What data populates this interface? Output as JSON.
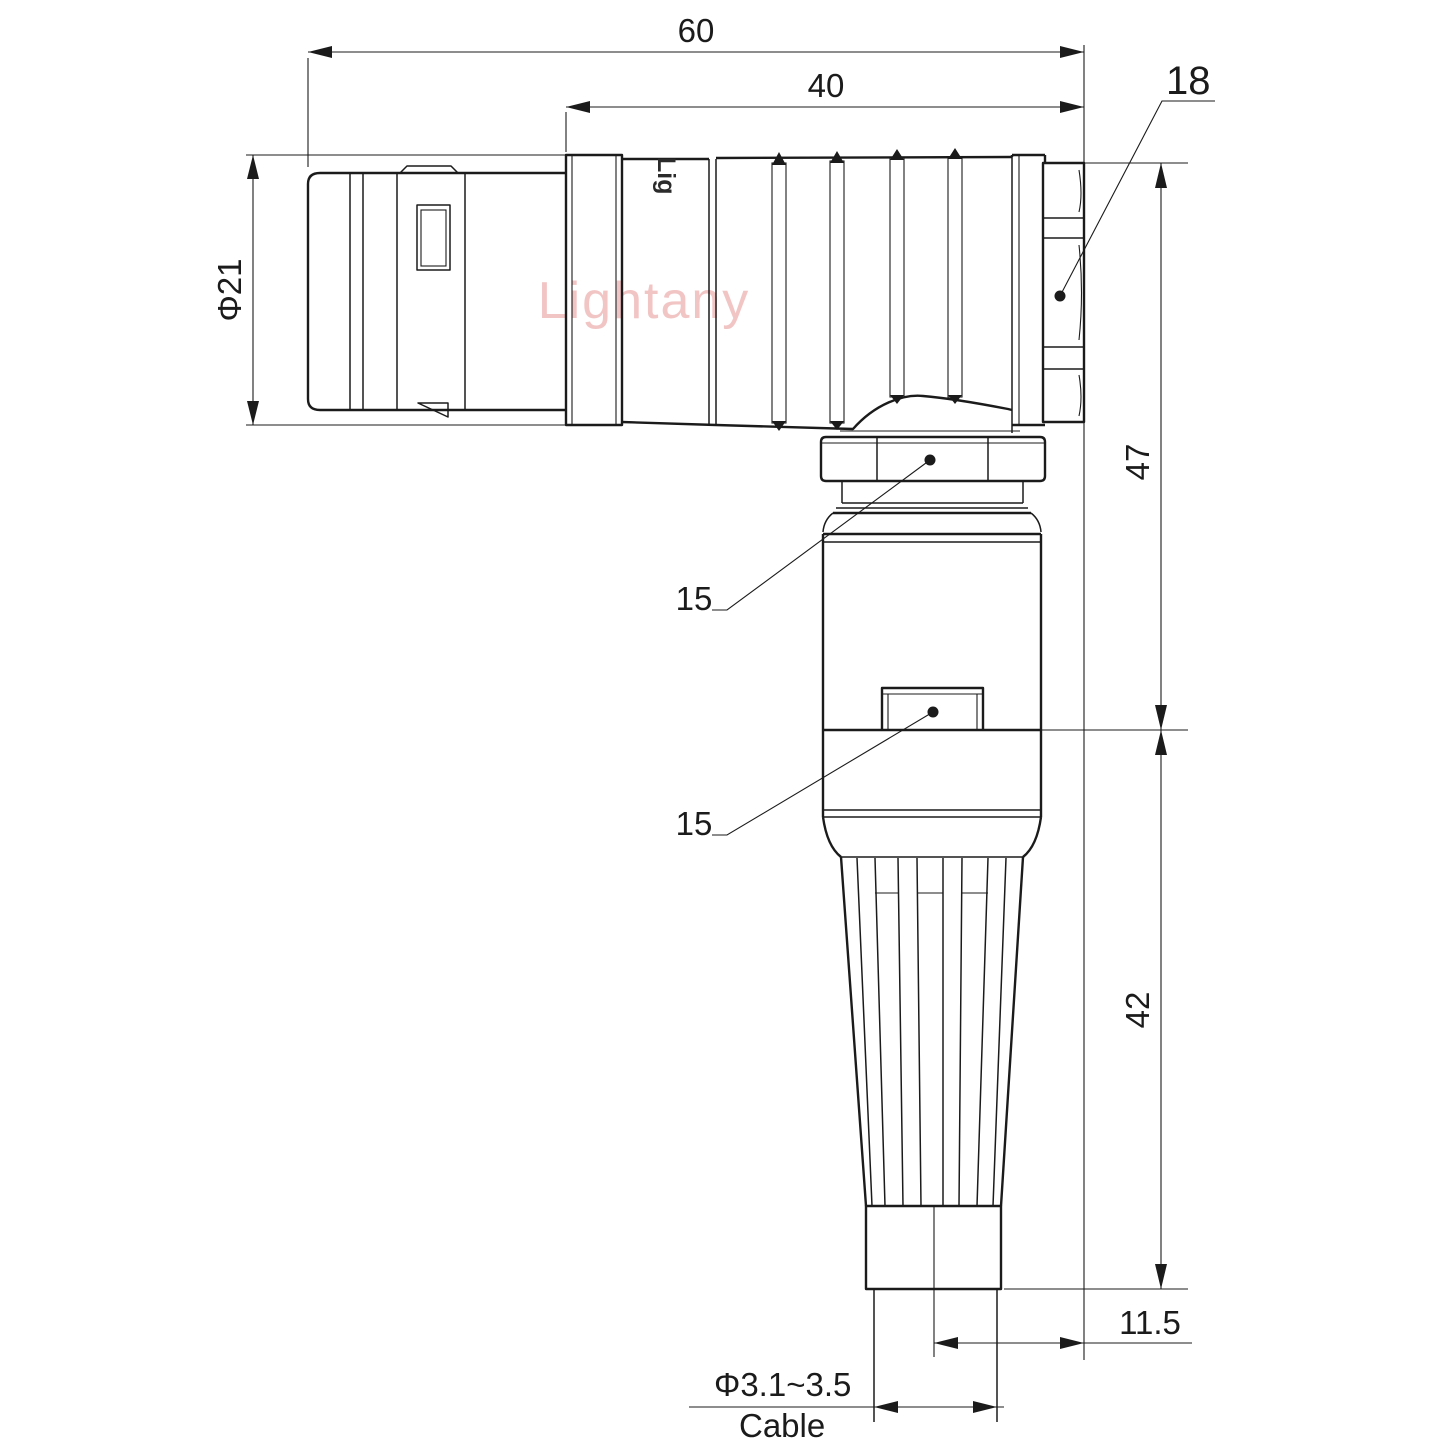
{
  "colors": {
    "line": "#1b1b1b",
    "watermark_pink": "#f2c5c5",
    "brand_print_gray": "#2b2b2b",
    "background": "#ffffff"
  },
  "watermark": {
    "text": "Lightany"
  },
  "brand": {
    "partial_print": "Lig"
  },
  "dimensions": {
    "overall_length": "60",
    "boot_length": "40",
    "coupling_nut_size": "18",
    "outer_diameter": "Φ21",
    "upper_height": "47",
    "lower_height": "42",
    "gland_nut_callout": "15",
    "latch_callout": "15",
    "cable_axis_offset": "11.5",
    "cable_diameter_range": "Φ3.1~3.5",
    "cable_caption": "Cable"
  }
}
